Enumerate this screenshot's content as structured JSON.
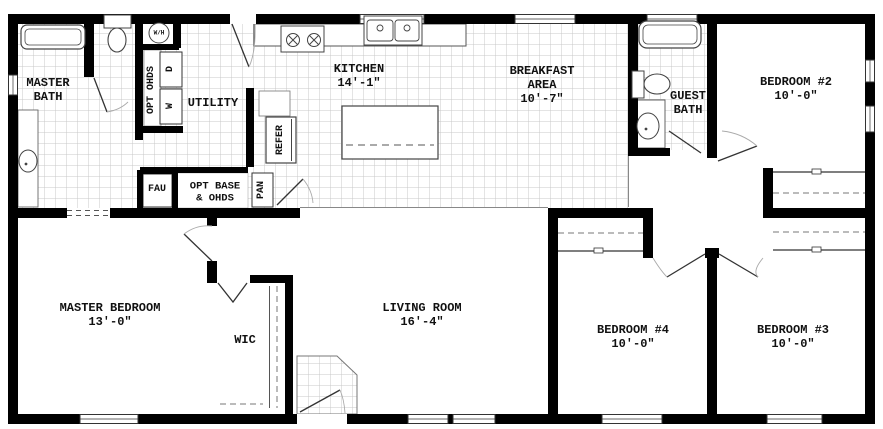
{
  "plan_title": "Single-story floor plan",
  "colors": {
    "wall": "#000000",
    "tile_line": "#c8c8c8",
    "fixture_outline": "#555555",
    "text": "#111111",
    "background": "#ffffff"
  },
  "rooms": {
    "master_bath": {
      "label": "MASTER\nBATH"
    },
    "utility": {
      "label": "UTILITY"
    },
    "kitchen": {
      "label": "KITCHEN\n14'-1\""
    },
    "breakfast": {
      "label": "BREAKFAST\nAREA\n10'-7\""
    },
    "guest_bath": {
      "label": "GUEST\nBATH"
    },
    "bedroom_2": {
      "label": "BEDROOM #2\n10'-0\""
    },
    "master_bedroom": {
      "label": "MASTER BEDROOM\n13'-0\""
    },
    "wic": {
      "label": "WIC"
    },
    "living_room": {
      "label": "LIVING ROOM\n16'-4\""
    },
    "bedroom_4": {
      "label": "BEDROOM #4\n10'-0\""
    },
    "bedroom_3": {
      "label": "BEDROOM #3\n10'-0\""
    }
  },
  "fixtures": {
    "opt_ohds": {
      "label": "OPT OHDS"
    },
    "dryer": {
      "label": "D"
    },
    "washer": {
      "label": "W"
    },
    "water_heater": {
      "label": "W/H"
    },
    "refrigerator": {
      "label": "REFER"
    },
    "pantry": {
      "label": "PAN"
    },
    "fau": {
      "label": "FAU"
    },
    "opt_base": {
      "label": "OPT BASE\n& OHDS"
    }
  }
}
